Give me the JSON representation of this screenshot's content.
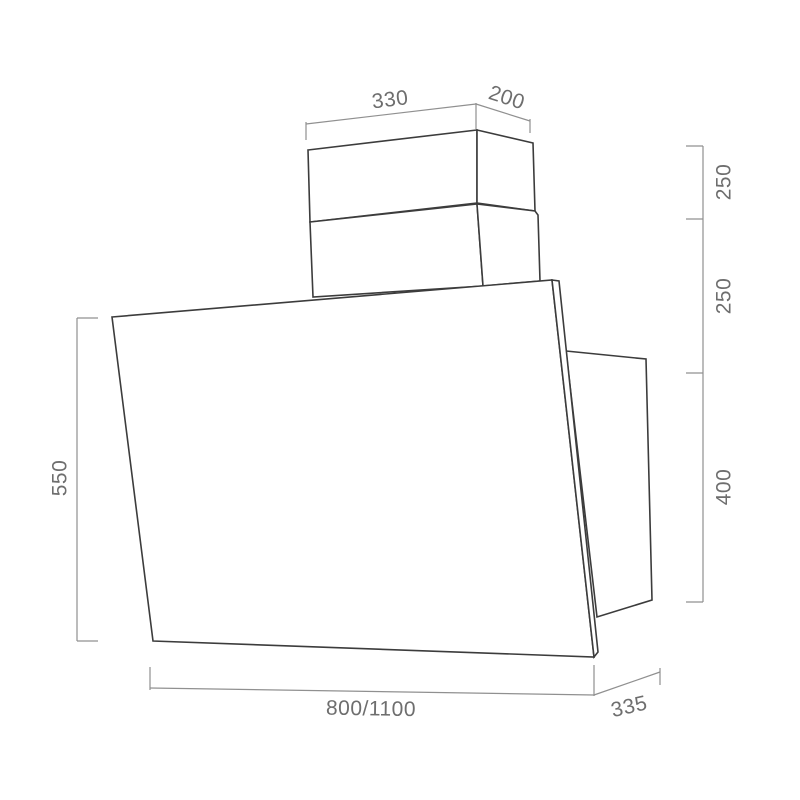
{
  "diagram": {
    "kind": "technical-drawing",
    "subject": "angled cooker hood with telescopic chimney, dimensional drawing",
    "colors": {
      "background": "#ffffff",
      "outline": "#3c3c3c",
      "dimension_lines": "#909090",
      "dimension_text": "#6e6e6e"
    },
    "dimensions": {
      "chimney_width": "330",
      "chimney_depth": "200",
      "chimney_upper_height": "250",
      "chimney_lower_height": "250",
      "rear_housing_height": "400",
      "panel_height": "550",
      "body_width": "800/1100",
      "body_depth": "335"
    }
  }
}
